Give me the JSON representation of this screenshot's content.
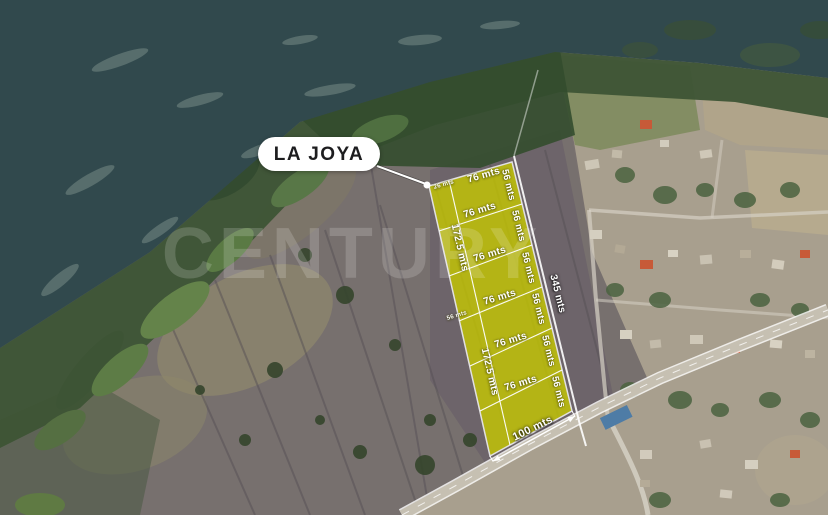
{
  "map": {
    "type": "satellite-aerial-listing",
    "watermark": "CENTURY",
    "parcel": {
      "name": "LA JOYA",
      "lot_count": 6,
      "labels": {
        "top_width": "76 mts",
        "top_offset": "26 mts",
        "lot_width": "76 mts",
        "lot_depth": "56 mts",
        "left_half_length": "172.5 mts",
        "left_segment": "56 mts",
        "road_frontage": "100 mts",
        "right_boundary_total": "345 mts"
      }
    },
    "colors": {
      "parcel_fill": "#c6c800",
      "parcel_line": "#ffffff",
      "water": "#31494d",
      "shoreline_green": "#3d5435",
      "field": "#79716f",
      "village": "#a89f8e",
      "road": "#c6c0b2",
      "label_text": "#ffffff",
      "place_pill_bg": "#ffffff",
      "place_pill_text": "#1d1d1f"
    }
  }
}
